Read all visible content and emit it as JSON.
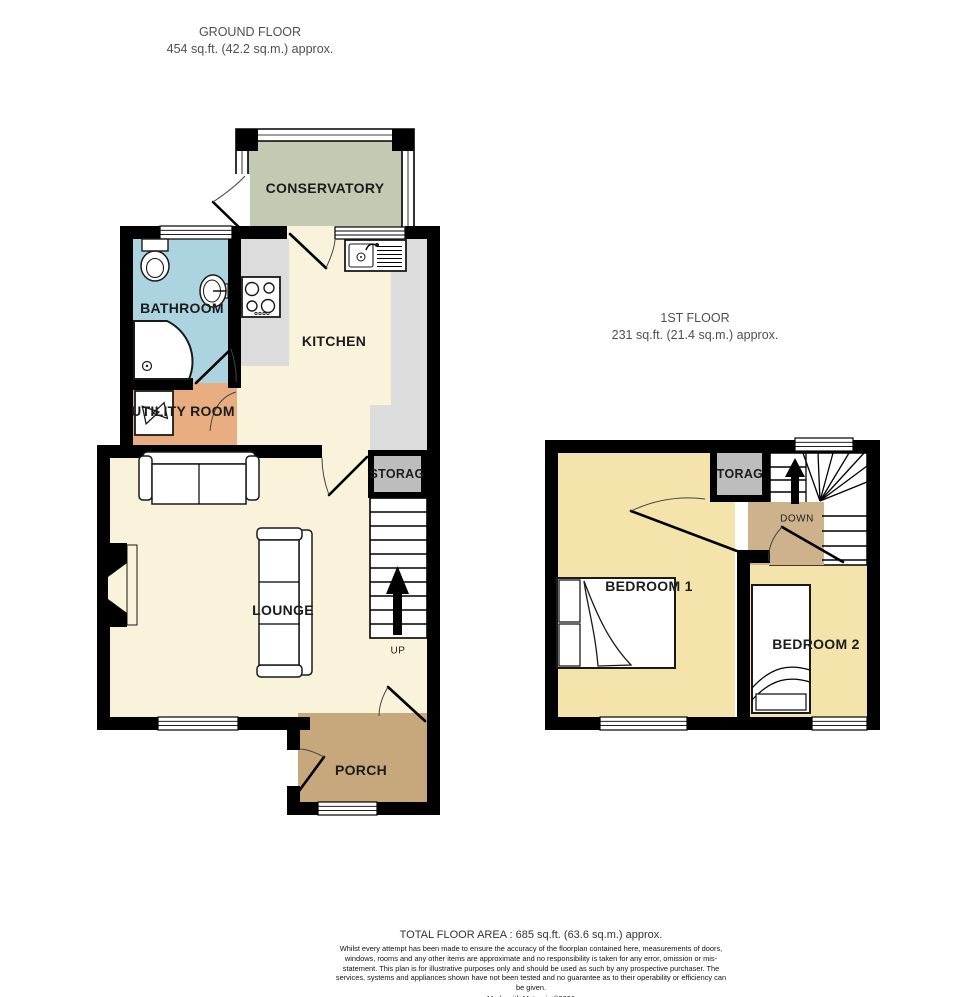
{
  "ground": {
    "title": "GROUND FLOOR",
    "subtitle": "454 sq.ft. (42.2 sq.m.) approx.",
    "conservatory": "CONSERVATORY",
    "bathroom": "BATHROOM",
    "kitchen": "KITCHEN",
    "utility": "UTILITY ROOM",
    "storage": "STORAG",
    "lounge": "LOUNGE",
    "porch": "PORCH",
    "up": "UP"
  },
  "first": {
    "title": "1ST FLOOR",
    "subtitle": "231 sq.ft. (21.4 sq.m.) approx.",
    "storage": "TORAG",
    "bedroom1": "BEDROOM 1",
    "bedroom2": "BEDROOM 2",
    "down": "DOWN"
  },
  "footer": {
    "total": "TOTAL FLOOR AREA : 685 sq.ft. (63.6 sq.m.) approx.",
    "disclaimer": "Whilst every attempt has been made to ensure the accuracy of the floorplan contained here, measurements of doors, windows, rooms and any other items are approximate and no responsibility is taken for any error, omission or mis-statement. This plan is for illustrative purposes only and should be used as such by any prospective purchaser. The services, systems and appliances shown have not been tested and no guarantee as to their operability or efficiency can be given.",
    "credit": "Made with Metropix ©2026"
  },
  "colors": {
    "wall": "#000000",
    "conservatory": "#c3c9b3",
    "bathroom": "#abd4e0",
    "cream": "#f8f3da",
    "utility": "#e9ad82",
    "porch": "#c7a87d",
    "bedroom": "#f4e4ab",
    "landing": "#cdb28b",
    "storage": "#bdbdbd",
    "counter": "#dcdcdc"
  }
}
